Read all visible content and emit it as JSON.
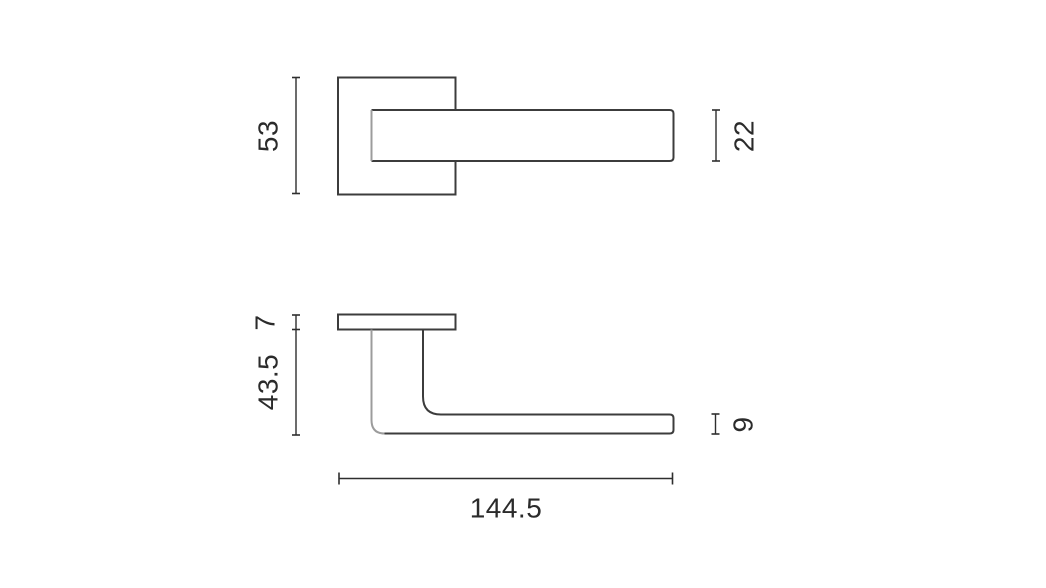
{
  "drawing": {
    "subject": "lever-handle-two-view-technical-drawing",
    "views": {
      "front": {
        "dims": {
          "rosette_height": "53",
          "lever_height": "22"
        }
      },
      "side": {
        "dims": {
          "rosette_thickness": "7",
          "projection": "43.5",
          "lever_thickness": "9",
          "total_length": "144.5"
        }
      }
    },
    "colors": {
      "outline": "#3c3c3c",
      "secondary_line": "#9c9c9c",
      "dimension_line": "#2e2e2e",
      "label_text": "#2b2b2b",
      "background": "#ffffff"
    }
  }
}
